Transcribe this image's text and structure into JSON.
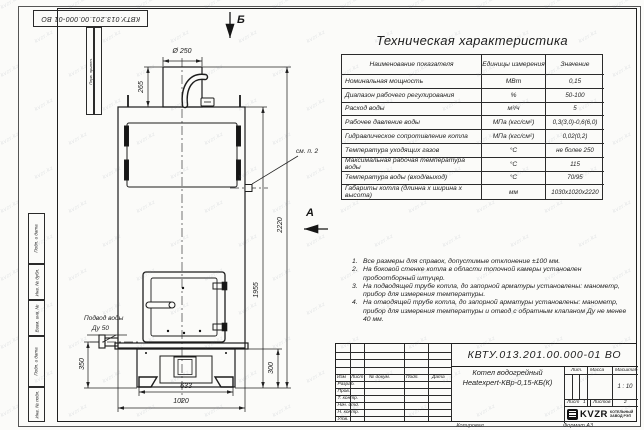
{
  "sheet": {
    "top_stamp": "КВТУ.013.201.00.000-01 ВО",
    "margin": {
      "perv_primen": "Перв. примен.",
      "podp_data_1": "Подп. и дата",
      "inv_dubl": "Инв. № дубл.",
      "vzam_inv": "Взам. инв. №",
      "podp_data_2": "Подп. и дата",
      "inv_podl": "Инв. № подл."
    },
    "footer": {
      "copied": "Копировал",
      "format": "Формат А3"
    }
  },
  "views": {
    "arrow_top": "Б",
    "arrow_side": "А",
    "callout_note2": "см. п. 2",
    "water_inlet_line1": "Подвод воды",
    "water_inlet_line2": "Ду 50"
  },
  "dimensions": {
    "chimney_diameter": "Ø 250",
    "chimney_height": "265",
    "overall_height": "2220",
    "body_height": "1955",
    "inlet_height": "350",
    "base_height": "300",
    "feet_width": "633",
    "body_width": "1020"
  },
  "spec": {
    "title": "Техническая характеристика",
    "headers": [
      "Наименование показателя",
      "Единицы измерения",
      "Значение"
    ],
    "rows": [
      [
        "Номинальная мощность",
        "МВт",
        "0,15"
      ],
      [
        "Диапазон рабочего регулирования",
        "%",
        "50-100"
      ],
      [
        "Расход воды",
        "м³/ч",
        "5"
      ],
      [
        "Рабочее давление воды",
        "МПа (кгс/см²)",
        "0,3(3,0)-0,6(6,0)"
      ],
      [
        "Гидравлическое сопротивление котла",
        "МПа (кгс/см²)",
        "0,02(0,2)"
      ],
      [
        "Температура уходящих газов",
        "°С",
        "не более 250"
      ],
      [
        "Максимальная рабочая температура воды",
        "°С",
        "115"
      ],
      [
        "Температура воды (вход/выход)",
        "°С",
        "70/95"
      ],
      [
        "Габариты котла (длинна х ширина х высота)",
        "мм",
        "1030х1020х2220"
      ]
    ]
  },
  "notes": {
    "items": [
      {
        "num": "1.",
        "text": "Все размеры для справок, допустимые отклонение ±100 мм."
      },
      {
        "num": "2.",
        "text": "На боковой стенке котла в области топочной камеры установлен пробоотборный штуцер."
      },
      {
        "num": "3.",
        "text": "На подводящей трубе котла, до запорной арматуры установлены: манометр, прибор для измерения температуры."
      },
      {
        "num": "4.",
        "text": "На отводящей трубе котла, до запорной арматуры установлены: манометр, прибор для измерения температуры и отвод с обратным клапаном Ду не менее 40 мм."
      }
    ]
  },
  "titleblock": {
    "doc_number": "КВТУ.013.201.00.000-01 ВО",
    "product_line1": "Котел водогрейный",
    "product_line2": "Heatexpert-КВр-0,15-КБ(К)",
    "col_headers": [
      "Изм",
      "Лист",
      "№ докум.",
      "Подп.",
      "Дата"
    ],
    "row_labels": [
      "Разраб.",
      "Пров.",
      "Т. контр.",
      "Нач. отд.",
      "Н. контр.",
      "Утв."
    ],
    "lit_label": "Лит.",
    "mass_label": "Масса",
    "scale_label": "Масштаб",
    "scale_value": "1 : 10",
    "sheet_label": "Лист",
    "sheet_value": "1",
    "sheets_label": "Листов",
    "sheets_value": "2",
    "logo_brand": "KVZR",
    "logo_caption1": "КОТЕЛЬНЫЙ",
    "logo_caption2": "ЗАВОД РЭП"
  },
  "watermark": {
    "text": "kvzr.kz"
  }
}
